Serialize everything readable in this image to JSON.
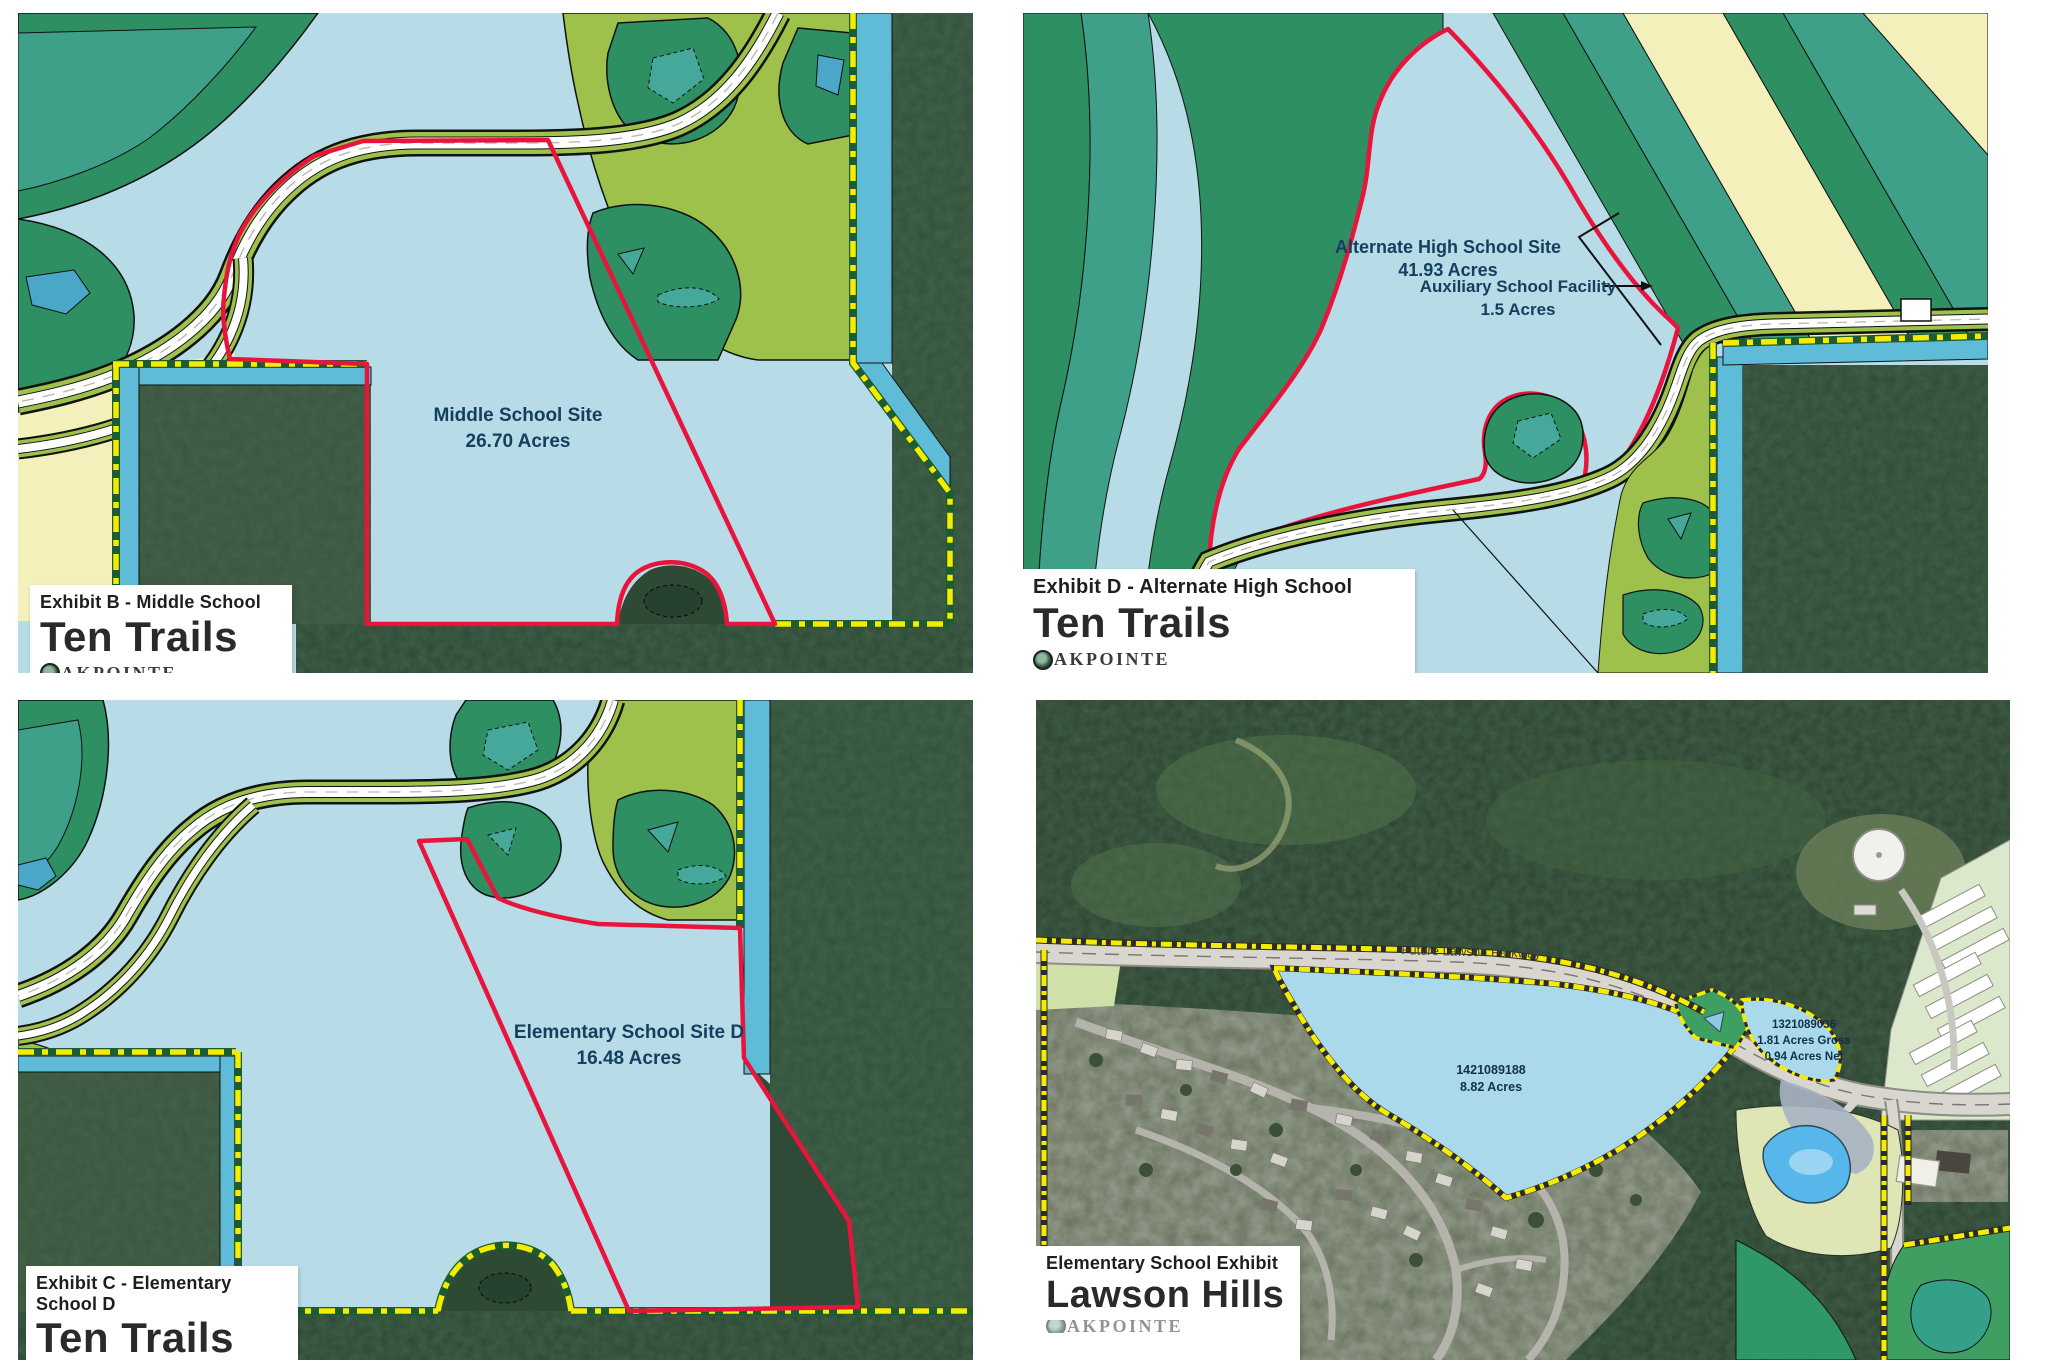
{
  "panels": {
    "middle_school": {
      "exhibit_label": "Exhibit B - Middle School",
      "project_name": "Ten Trails",
      "brand_suffix": "AKPOINTE",
      "site_line1": "Middle School Site",
      "site_line2": "26.70 Acres"
    },
    "alternate_high_school": {
      "exhibit_label": "Exhibit D - Alternate High School",
      "project_name": "Ten Trails",
      "brand_suffix": "AKPOINTE",
      "site_line1": "Alternate High School Site",
      "site_line2": "41.93 Acres",
      "aux_line1": "Auxiliary School Facility",
      "aux_line2": "1.5 Acres"
    },
    "elementary_d": {
      "exhibit_label": "Exhibit C - Elementary School D",
      "project_name": "Ten Trails",
      "brand_suffix": "AKPOINTE",
      "site_line1": "Elementary School Site D",
      "site_line2": "16.48 Acres"
    },
    "lawson_hills": {
      "exhibit_label": "Elementary School Exhibit",
      "project_name": "Lawson Hills",
      "brand_suffix": "AKPOINTE",
      "road_label": "Future Lawson Parkway",
      "parcel_main_line1": "1421089188",
      "parcel_main_line2": "8.82 Acres",
      "parcel_small_line1": "1321089036",
      "parcel_small_line2": "1.81 Acres Gross",
      "parcel_small_line3": "0.94 Acres Net"
    }
  },
  "colors": {
    "map_light_blue": "#b7dbe7",
    "site_boundary_red": "#e8143c",
    "boundary_yellow": "#f5ec00",
    "water_strip_cyan": "#5fbcd9",
    "open_space_dark_green": "#2e8f63",
    "open_space_teal": "#3fa08a",
    "parks_olive": "#9dc14b",
    "pond_teal": "#45a89b",
    "cream": "#f4f0bc",
    "label_navy": "#14405e"
  }
}
